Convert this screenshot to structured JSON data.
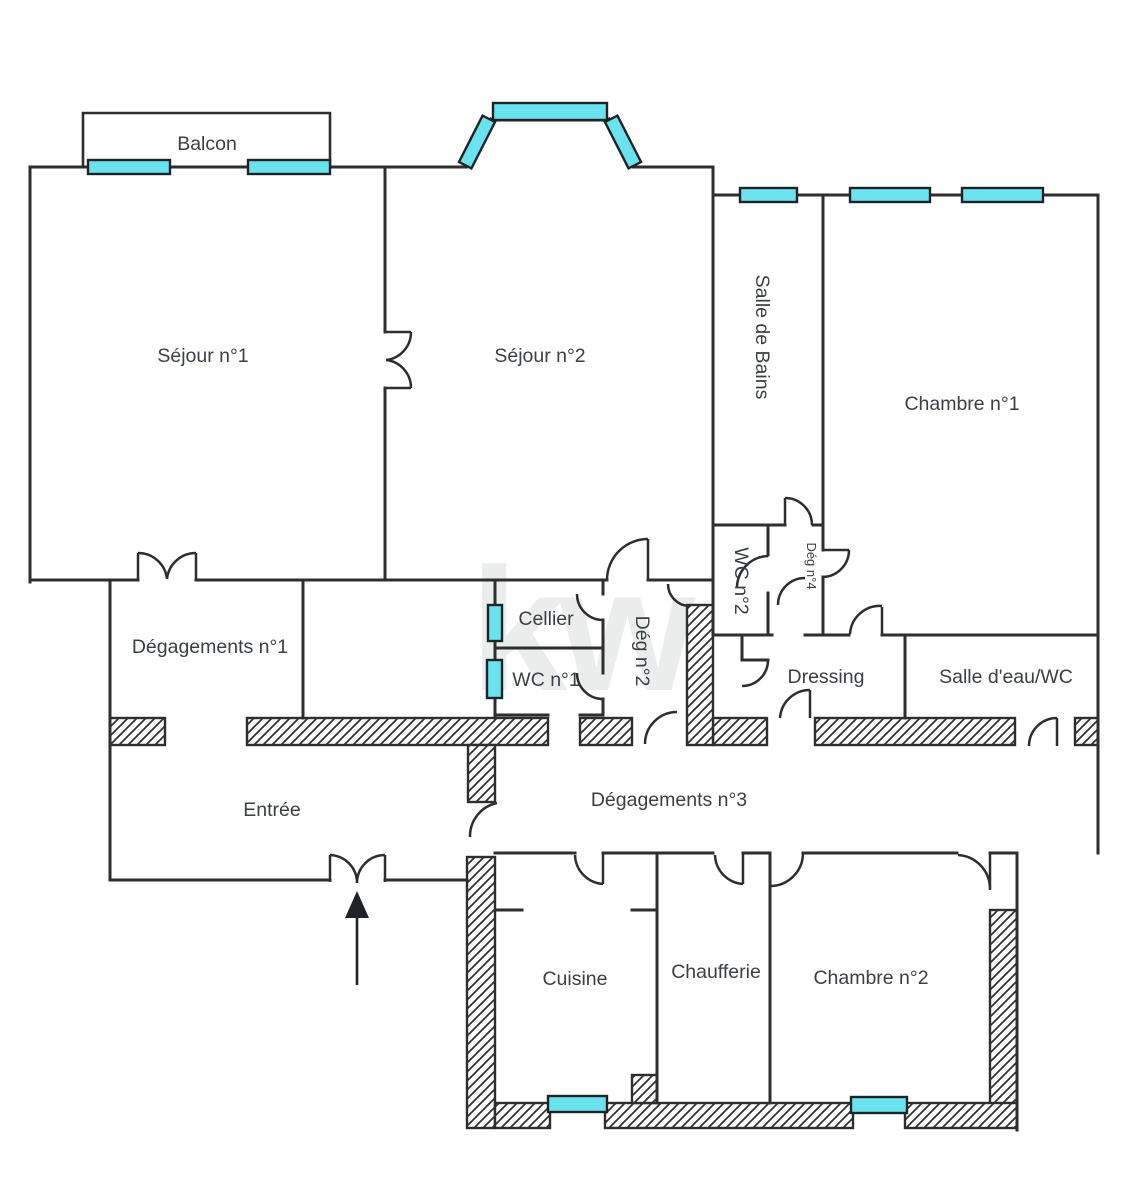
{
  "watermark": "kw",
  "colors": {
    "wall": "#2E2E2E",
    "window_fill": "#6BE3EE",
    "label_text": "#3A3F45",
    "watermark_gray": "#C9D1CF",
    "background": "#FFFFFF"
  },
  "icons": {
    "entrance_arrow": "arrow-up"
  },
  "rooms": [
    {
      "id": "balcon",
      "label": "Balcon"
    },
    {
      "id": "sejour-1",
      "label": "Séjour n°1"
    },
    {
      "id": "sejour-2",
      "label": "Séjour n°2"
    },
    {
      "id": "salle-de-bains",
      "label": "Salle de Bains"
    },
    {
      "id": "chambre-1",
      "label": "Chambre n°1"
    },
    {
      "id": "degagements-1",
      "label": "Dégagements n°1"
    },
    {
      "id": "cellier",
      "label": "Cellier"
    },
    {
      "id": "wc-1",
      "label": "WC n°1"
    },
    {
      "id": "deg-2",
      "label": "Dég n°2"
    },
    {
      "id": "wc-2",
      "label": "WC n°2"
    },
    {
      "id": "deg-4",
      "label": "Dég n°4"
    },
    {
      "id": "dressing",
      "label": "Dressing"
    },
    {
      "id": "salle-eau-wc",
      "label": "Salle d'eau/WC"
    },
    {
      "id": "entree",
      "label": "Entrée"
    },
    {
      "id": "degagements-3",
      "label": "Dégagements n°3"
    },
    {
      "id": "cuisine",
      "label": "Cuisine"
    },
    {
      "id": "chaufferie",
      "label": "Chaufferie"
    },
    {
      "id": "chambre-2",
      "label": "Chambre n°2"
    }
  ]
}
